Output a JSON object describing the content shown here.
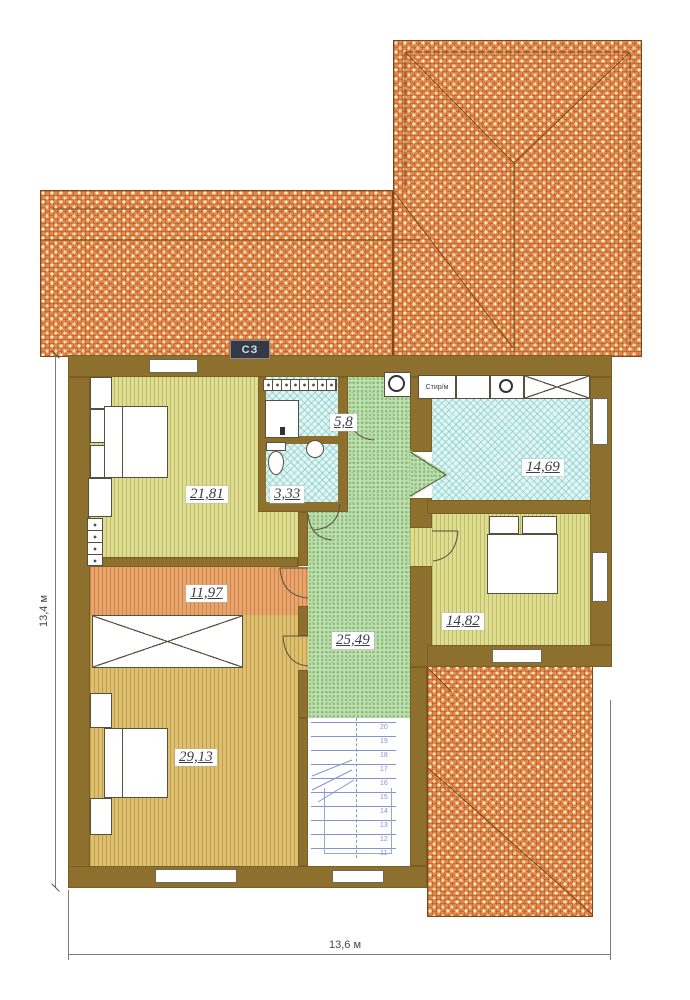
{
  "plan": {
    "compass": {
      "label": "СЗ"
    },
    "rooms": {
      "bedroom1": {
        "area": "21,81"
      },
      "laundry": {
        "area": "5,8"
      },
      "wc": {
        "area": "3,33"
      },
      "bathroom": {
        "area": "14,69"
      },
      "corridor": {
        "area": "11,97"
      },
      "hall": {
        "area": "25,49"
      },
      "bedroom2": {
        "area": "14,82"
      },
      "bedroom3": {
        "area": "29,13"
      }
    },
    "fixtures": {
      "washer_label": "Стир/м"
    },
    "dimensions": {
      "left": "13,4 м",
      "bottom": "13,6 м"
    },
    "stairs": {
      "steps": [
        "20",
        "19",
        "18",
        "17",
        "16",
        "15",
        "14",
        "13",
        "12",
        "11"
      ]
    },
    "colors": {
      "wall": "#8d6f2e",
      "roof": "#e2884a",
      "floor_yellow": "#dedd92",
      "floor_tan": "#dcbf70",
      "floor_orange": "#e7a56d",
      "floor_cyan": "#e2f5f3",
      "floor_green": "#bedfb0",
      "stair_blue": "#8594cf"
    }
  }
}
